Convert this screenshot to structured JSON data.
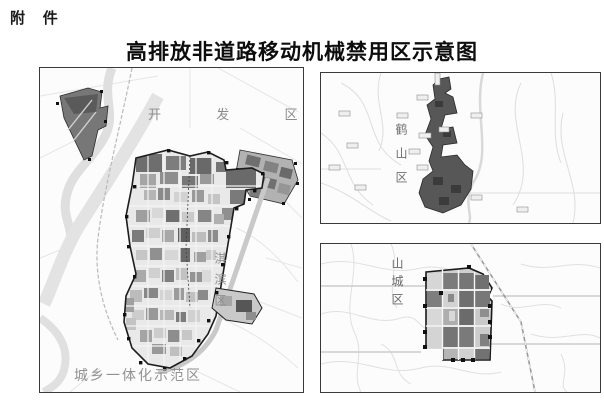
{
  "header": {
    "attachment_label": "附 件",
    "title": "高排放非道路移动机械禁用区示意图"
  },
  "main_map": {
    "development_zone_label": "开 发 区",
    "qibin_district_label": "淇滨区",
    "integration_zone_label": "城乡一体化示范区"
  },
  "heshan_map": {
    "district_label": "鹤山区"
  },
  "shancheng_map": {
    "district_label": "山城区"
  },
  "colors": {
    "page_bg": "#ffffff",
    "panel_border": "#3a3a3a",
    "zone_boundary": "#1d1d1d",
    "zone_dark": "#5c5c5c",
    "zone_medium": "#9c9c9c",
    "zone_light": "#d8d8d8",
    "map_road": "#e2e2e2",
    "river": "#dfdfdf",
    "label_gray": "#8c8c8c",
    "title_color": "#0d0d0d"
  }
}
